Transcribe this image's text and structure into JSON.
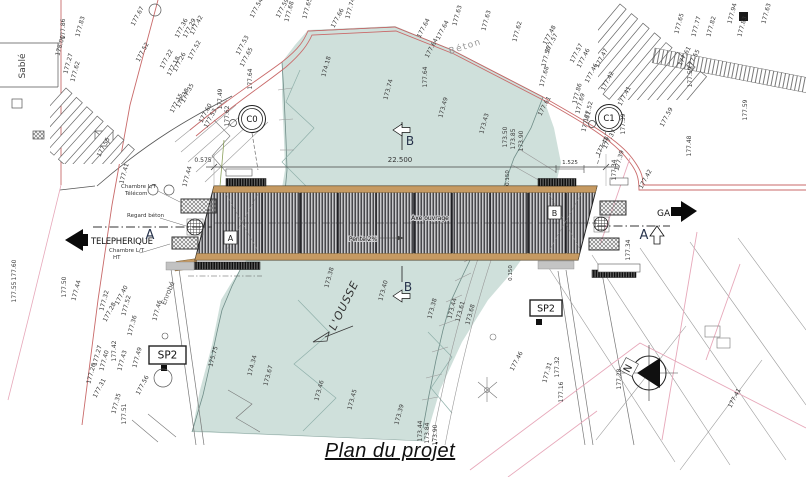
{
  "caption": "Plan du projet",
  "colors": {
    "river": "#cfe0db",
    "deck_wood": "#c69a62",
    "deck_hatch": "#28282c",
    "red_line": "#c96a6a",
    "pink_line": "#e7a8ba",
    "ink": "#3a3a3a"
  },
  "annotations": {
    "telepherique": "TELEPHERIQUE",
    "gare": "GARE",
    "river_name": "L'OUSSE",
    "sable": "Sablé",
    "beton": "Béton",
    "enrobe": "Enrobé",
    "section_a": "A",
    "section_b": "B",
    "ref_a": "A",
    "ref_b": "B",
    "marker_c0": "C0",
    "marker_c1": "C1",
    "sp2": "SP2",
    "north": "N",
    "axe_ouvrage": "Axe ouvrage",
    "pente": "Pente 2%",
    "chambre_lt": "Chambre L/T",
    "telecom": "Télécom",
    "regard_beton": "Regard béton",
    "ht": "HT",
    "dim_total": "22.500",
    "dim_left": "0.575",
    "dim_right": "1.525",
    "dim_edge": "0.150"
  },
  "spot_elevations": [
    {
      "t": "178.00",
      "x": 62,
      "y": 46,
      "r": -75
    },
    {
      "t": "177.27",
      "x": 70,
      "y": 64,
      "r": -75
    },
    {
      "t": "177.62",
      "x": 77,
      "y": 72,
      "r": -75
    },
    {
      "t": "177.86",
      "x": 65,
      "y": 29,
      "r": -90
    },
    {
      "t": "177.83",
      "x": 82,
      "y": 27,
      "r": -75
    },
    {
      "t": "177.67",
      "x": 139,
      "y": 17,
      "r": -62
    },
    {
      "t": "177.52",
      "x": 144,
      "y": 53,
      "r": -62
    },
    {
      "t": "177.55",
      "x": 105,
      "y": 148,
      "r": -62
    },
    {
      "t": "177.36",
      "x": 183,
      "y": 29,
      "r": -62
    },
    {
      "t": "177.29",
      "x": 191,
      "y": 29,
      "r": -62
    },
    {
      "t": "177.42",
      "x": 198,
      "y": 26,
      "r": -62
    },
    {
      "t": "177.52",
      "x": 196,
      "y": 51,
      "r": -62
    },
    {
      "t": "177.22",
      "x": 168,
      "y": 60,
      "r": -62
    },
    {
      "t": "177.18",
      "x": 175,
      "y": 67,
      "r": -62
    },
    {
      "t": "177.26",
      "x": 181,
      "y": 63,
      "r": -62
    },
    {
      "t": "177.15",
      "x": 178,
      "y": 104,
      "r": -62
    },
    {
      "t": "177.38",
      "x": 184,
      "y": 99,
      "r": -62
    },
    {
      "t": "177.35",
      "x": 189,
      "y": 94,
      "r": -62
    },
    {
      "t": "177.60",
      "x": 207,
      "y": 114,
      "r": -62
    },
    {
      "t": "177.53",
      "x": 212,
      "y": 119,
      "r": -62
    },
    {
      "t": "177.49",
      "x": 222,
      "y": 99,
      "r": -90
    },
    {
      "t": "177.62",
      "x": 229,
      "y": 116,
      "r": -90
    },
    {
      "t": "177.64",
      "x": 252,
      "y": 79,
      "r": -90
    },
    {
      "t": "177.53",
      "x": 244,
      "y": 46,
      "r": -62
    },
    {
      "t": "177.65",
      "x": 248,
      "y": 58,
      "r": -62
    },
    {
      "t": "177.54",
      "x": 258,
      "y": 9,
      "r": -62
    },
    {
      "t": "177.59",
      "x": 284,
      "y": 9,
      "r": -62
    },
    {
      "t": "177.68",
      "x": 291,
      "y": 12,
      "r": -75
    },
    {
      "t": "177.65",
      "x": 309,
      "y": 9,
      "r": -75
    },
    {
      "t": "177.66",
      "x": 339,
      "y": 19,
      "r": -62
    },
    {
      "t": "177.74",
      "x": 352,
      "y": 9,
      "r": -75
    },
    {
      "t": "174.18",
      "x": 328,
      "y": 67,
      "r": -75
    },
    {
      "t": "173.74",
      "x": 390,
      "y": 90,
      "r": -75
    },
    {
      "t": "173.49",
      "x": 445,
      "y": 108,
      "r": -75
    },
    {
      "t": "173.43",
      "x": 486,
      "y": 124,
      "r": -75
    },
    {
      "t": "173.50",
      "x": 507,
      "y": 137,
      "r": -90
    },
    {
      "t": "173.85",
      "x": 515,
      "y": 139,
      "r": -90
    },
    {
      "t": "173.90",
      "x": 523,
      "y": 141,
      "r": -90
    },
    {
      "t": "177.64",
      "x": 425,
      "y": 29,
      "r": -62
    },
    {
      "t": "177.64",
      "x": 444,
      "y": 31,
      "r": -62
    },
    {
      "t": "177.63",
      "x": 459,
      "y": 16,
      "r": -75
    },
    {
      "t": "177.63",
      "x": 488,
      "y": 21,
      "r": -75
    },
    {
      "t": "177.62",
      "x": 519,
      "y": 32,
      "r": -75
    },
    {
      "t": "177.64",
      "x": 433,
      "y": 49,
      "r": -62
    },
    {
      "t": "177.64",
      "x": 427,
      "y": 77,
      "r": -90
    },
    {
      "t": "177.48",
      "x": 551,
      "y": 36,
      "r": -62
    },
    {
      "t": "177.57",
      "x": 553,
      "y": 44,
      "r": -62
    },
    {
      "t": "177.56",
      "x": 548,
      "y": 57,
      "r": -75
    },
    {
      "t": "177.68",
      "x": 546,
      "y": 77,
      "r": -75
    },
    {
      "t": "177.57",
      "x": 578,
      "y": 54,
      "r": -62
    },
    {
      "t": "177.46",
      "x": 585,
      "y": 59,
      "r": -62
    },
    {
      "t": "177.47",
      "x": 603,
      "y": 59,
      "r": -62
    },
    {
      "t": "177.46",
      "x": 593,
      "y": 74,
      "r": -62
    },
    {
      "t": "177.42",
      "x": 609,
      "y": 82,
      "r": -62
    },
    {
      "t": "177.41",
      "x": 626,
      "y": 97,
      "r": -62
    },
    {
      "t": "177.86",
      "x": 579,
      "y": 94,
      "r": -75
    },
    {
      "t": "177.69",
      "x": 582,
      "y": 104,
      "r": -75
    },
    {
      "t": "177.52",
      "x": 590,
      "y": 112,
      "r": -75
    },
    {
      "t": "177.61",
      "x": 588,
      "y": 122,
      "r": -75
    },
    {
      "t": "177.61",
      "x": 546,
      "y": 107,
      "r": -62
    },
    {
      "t": "177.39",
      "x": 625,
      "y": 124,
      "r": -90
    },
    {
      "t": "177.37",
      "x": 611,
      "y": 140,
      "r": -62
    },
    {
      "t": "177.48",
      "x": 604,
      "y": 147,
      "r": -62
    },
    {
      "t": "177.65",
      "x": 681,
      "y": 24,
      "r": -75
    },
    {
      "t": "177.77",
      "x": 698,
      "y": 27,
      "r": -75
    },
    {
      "t": "177.82",
      "x": 713,
      "y": 27,
      "r": -75
    },
    {
      "t": "177.94",
      "x": 734,
      "y": 14,
      "r": -75
    },
    {
      "t": "177.83",
      "x": 744,
      "y": 27,
      "r": -75
    },
    {
      "t": "177.63",
      "x": 768,
      "y": 14,
      "r": -75
    },
    {
      "t": "177.61",
      "x": 686,
      "y": 57,
      "r": -62
    },
    {
      "t": "177.55",
      "x": 695,
      "y": 60,
      "r": -62
    },
    {
      "t": "177.59",
      "x": 692,
      "y": 77,
      "r": -90
    },
    {
      "t": "177.59",
      "x": 747,
      "y": 110,
      "r": -90
    },
    {
      "t": "177.48",
      "x": 691,
      "y": 146,
      "r": -90
    },
    {
      "t": "177.59",
      "x": 668,
      "y": 118,
      "r": -62
    },
    {
      "t": "177.41",
      "x": 126,
      "y": 174,
      "r": -75
    },
    {
      "t": "177.44",
      "x": 189,
      "y": 177,
      "r": -75
    },
    {
      "t": "177.42",
      "x": 647,
      "y": 180,
      "r": -62
    },
    {
      "t": "177.34",
      "x": 616,
      "y": 170,
      "r": -90
    },
    {
      "t": "177.39",
      "x": 621,
      "y": 161,
      "r": -75
    },
    {
      "t": "177.34",
      "x": 630,
      "y": 250,
      "r": -90
    },
    {
      "t": "173.38",
      "x": 331,
      "y": 278,
      "r": -75
    },
    {
      "t": "173.40",
      "x": 385,
      "y": 291,
      "r": -75
    },
    {
      "t": "177.50",
      "x": 66,
      "y": 287,
      "r": -90
    },
    {
      "t": "177.44",
      "x": 78,
      "y": 291,
      "r": -75
    },
    {
      "t": "177.32",
      "x": 106,
      "y": 301,
      "r": -75
    },
    {
      "t": "177.28",
      "x": 111,
      "y": 313,
      "r": -62
    },
    {
      "t": "177.40",
      "x": 123,
      "y": 296,
      "r": -62
    },
    {
      "t": "177.52",
      "x": 128,
      "y": 306,
      "r": -75
    },
    {
      "t": "177.36",
      "x": 134,
      "y": 326,
      "r": -75
    },
    {
      "t": "177.46",
      "x": 159,
      "y": 311,
      "r": -75
    },
    {
      "t": "177.27",
      "x": 99,
      "y": 356,
      "r": -75
    },
    {
      "t": "177.40",
      "x": 106,
      "y": 361,
      "r": -75
    },
    {
      "t": "177.42",
      "x": 116,
      "y": 351,
      "r": -90
    },
    {
      "t": "177.43",
      "x": 124,
      "y": 361,
      "r": -75
    },
    {
      "t": "177.49",
      "x": 139,
      "y": 358,
      "r": -75
    },
    {
      "t": "177.26",
      "x": 93,
      "y": 374,
      "r": -75
    },
    {
      "t": "177.31",
      "x": 101,
      "y": 389,
      "r": -62
    },
    {
      "t": "177.35",
      "x": 118,
      "y": 404,
      "r": -75
    },
    {
      "t": "177.51",
      "x": 126,
      "y": 414,
      "r": -90
    },
    {
      "t": "177.56",
      "x": 144,
      "y": 386,
      "r": -62
    },
    {
      "t": "175.75",
      "x": 215,
      "y": 357,
      "r": -75
    },
    {
      "t": "174.34",
      "x": 254,
      "y": 366,
      "r": -75
    },
    {
      "t": "173.67",
      "x": 270,
      "y": 376,
      "r": -75
    },
    {
      "t": "177.60",
      "x": 16,
      "y": 270,
      "r": -90
    },
    {
      "t": "177.55",
      "x": 16,
      "y": 292,
      "r": -90
    },
    {
      "t": "173.46",
      "x": 321,
      "y": 391,
      "r": -75
    },
    {
      "t": "173.45",
      "x": 354,
      "y": 400,
      "r": -75
    },
    {
      "t": "173.39",
      "x": 401,
      "y": 415,
      "r": -75
    },
    {
      "t": "173.38",
      "x": 434,
      "y": 309,
      "r": -75
    },
    {
      "t": "173.44",
      "x": 454,
      "y": 309,
      "r": -75
    },
    {
      "t": "173.61",
      "x": 462,
      "y": 312,
      "r": -75
    },
    {
      "t": "173.68",
      "x": 472,
      "y": 315,
      "r": -75
    },
    {
      "t": "177.46",
      "x": 518,
      "y": 362,
      "r": -62
    },
    {
      "t": "173.44",
      "x": 422,
      "y": 431,
      "r": -90
    },
    {
      "t": "173.84",
      "x": 429,
      "y": 433,
      "r": -90
    },
    {
      "t": "173.90",
      "x": 437,
      "y": 435,
      "r": -90
    },
    {
      "t": "177.31",
      "x": 549,
      "y": 373,
      "r": -75
    },
    {
      "t": "177.32",
      "x": 559,
      "y": 367,
      "r": -90
    },
    {
      "t": "177.16",
      "x": 563,
      "y": 392,
      "r": -90
    },
    {
      "t": "177.28",
      "x": 621,
      "y": 379,
      "r": -90
    },
    {
      "t": "177.41",
      "x": 736,
      "y": 399,
      "r": -62
    }
  ]
}
